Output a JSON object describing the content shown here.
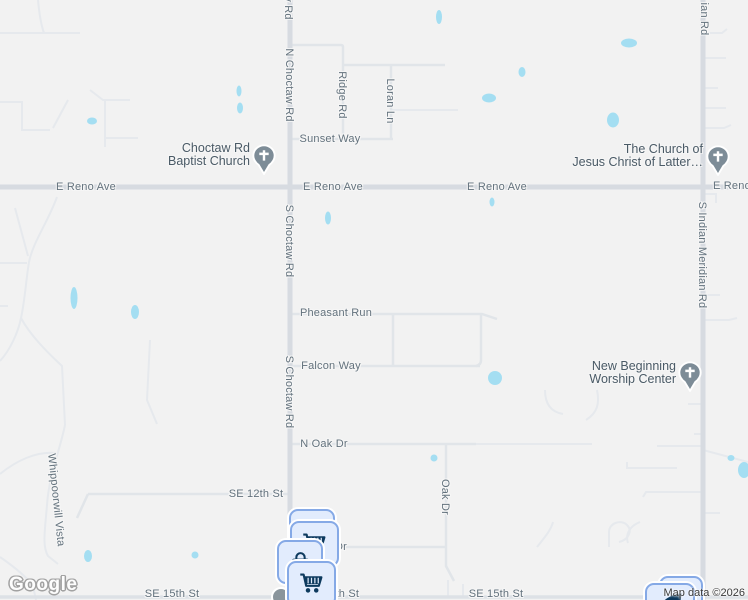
{
  "roads": {
    "e_reno_ave": "E Reno Ave",
    "e_reno_partial": "E Reno",
    "n_choctaw_rd": "N Choctaw Rd",
    "s_choctaw_rd": "S Choctaw Rd",
    "rd_fragment": "y Rd",
    "meridian_fragment": "ian Rd",
    "s_indian_meridian_rd": "S Indian Meridian Rd",
    "ridge_rd": "Ridge Rd",
    "loran_ln": "Loran Ln",
    "sunset_way": "Sunset Way",
    "pheasant_run": "Pheasant Run",
    "falcon_way": "Falcon Way",
    "n_oak_dr": "N Oak Dr",
    "oak_dr": "Oak Dr",
    "se_12th_st": "SE 12th St",
    "se_15th_st": "SE 15th St",
    "dr_fragment": "Dr",
    "fifteenth_fragment": "15th St",
    "whippoorwill_vista": "Whippoorwill Vista"
  },
  "pois": {
    "choctaw_baptist": {
      "line1": "Choctaw Rd",
      "line2": "Baptist Church"
    },
    "lds_church": {
      "line1": "The Church of",
      "line2": "Jesus Christ of Latter…"
    },
    "new_beginning": {
      "line1": "New Beginning",
      "line2": "Worship Center"
    }
  },
  "icons": {
    "church_pin": "church-cross-pin",
    "cart": "shopping-cart",
    "bag": "shopping-bag"
  },
  "attribution": {
    "logo": "Google",
    "map_data": "Map data ©2026"
  },
  "colors": {
    "background": "#f2f2f2",
    "road_major": "#d7dbe1",
    "road_minor": "#e1e5e9",
    "road_faint": "#e6e9ed",
    "pond": "#a4def2",
    "road_label": "#63727d",
    "poi_label": "#4a5a66",
    "pin_fill": "#7d8c97",
    "badge_bg": "#e2ecfd",
    "badge_border": "#85a9e6",
    "badge_glyph": "#0d3a5e"
  }
}
